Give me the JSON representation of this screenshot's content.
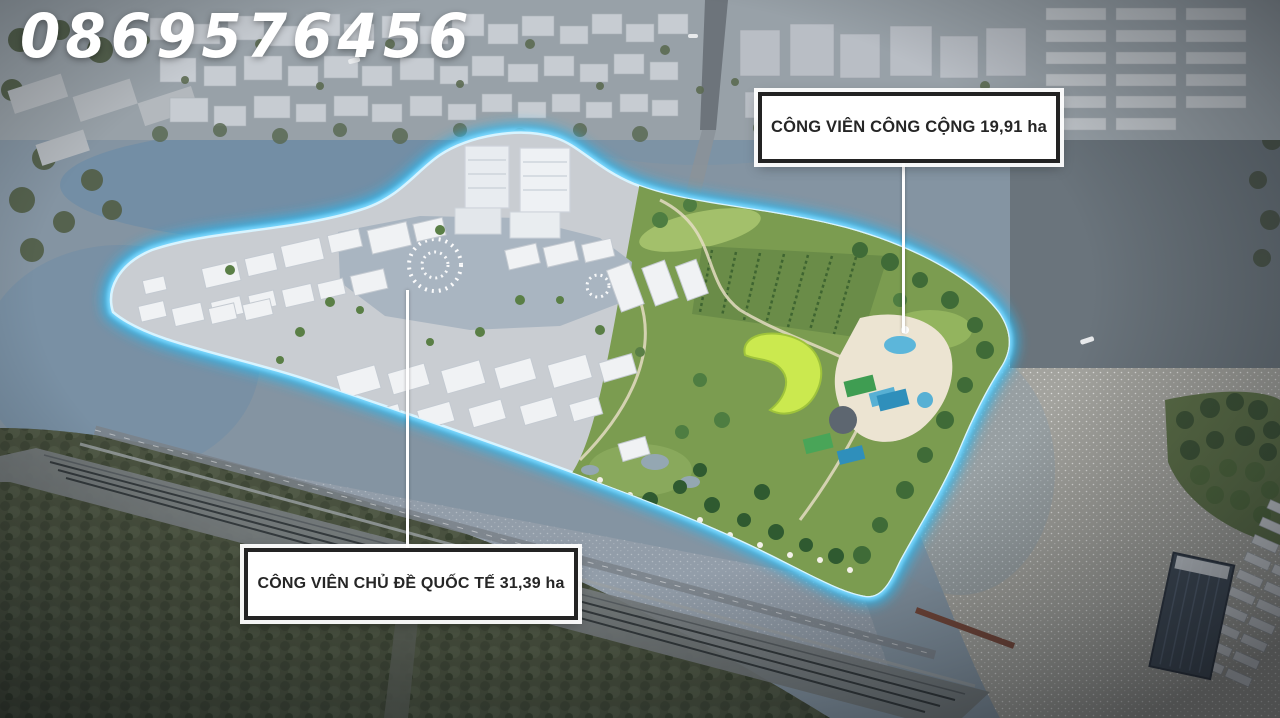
{
  "watermark": {
    "phone": "0869576456"
  },
  "callouts": [
    {
      "id": "public-park",
      "text": "CÔNG VIÊN CÔNG CỘNG 19,91 ha",
      "name": "CÔNG VIÊN CÔNG CỘNG",
      "area_ha": "19,91"
    },
    {
      "id": "theme-park",
      "text": "CÔNG VIÊN CHỦ ĐỀ QUỐC TẾ 31,39 ha",
      "name": "CÔNG VIÊN CHỦ ĐỀ QUỐC TẾ",
      "area_ha": "31,39"
    }
  ],
  "colors": {
    "island_glow": "#45c8f5",
    "island_glow_bright": "#d8f4ff",
    "label_background": "#ffffff",
    "label_border": "#232323",
    "label_text": "#262626",
    "watermark_text": "#ffffff",
    "park_green": "#7b9c50",
    "river_gray_blue": "#8494a2"
  }
}
